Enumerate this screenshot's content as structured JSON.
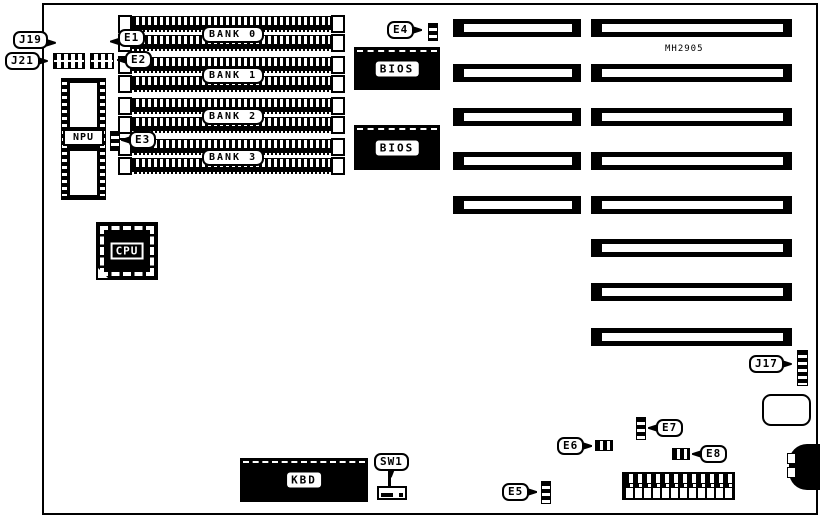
{
  "board": {
    "model_label": "MH2905"
  },
  "memory_banks": [
    {
      "label": "BANK 0"
    },
    {
      "label": "BANK 1"
    },
    {
      "label": "BANK 2"
    },
    {
      "label": "BANK 3"
    }
  ],
  "chips": {
    "npu": "NPU",
    "cpu": "CPU",
    "bios_top": "BIOS",
    "bios_bottom": "BIOS",
    "kbd": "KBD"
  },
  "callouts": {
    "j19": "J19",
    "j21": "J21",
    "j17": "J17",
    "e1": "E1",
    "e2": "E2",
    "e3": "E3",
    "e4": "E4",
    "e5": "E5",
    "e6": "E6",
    "e7": "E7",
    "e8": "E8",
    "sw1": "SW1"
  },
  "colors": {
    "ink": "#000000",
    "paper": "#ffffff"
  }
}
